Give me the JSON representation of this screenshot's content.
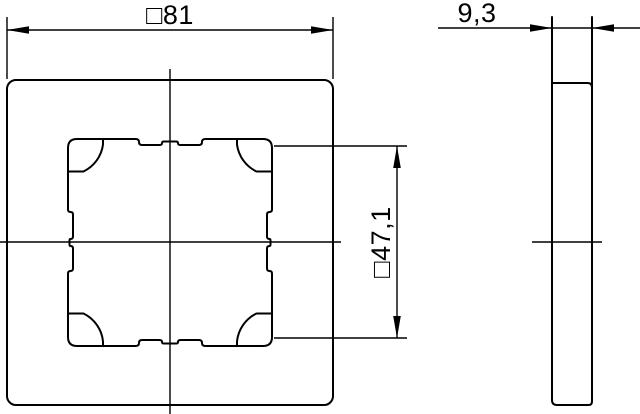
{
  "colors": {
    "line": "#000000",
    "background": "#ffffff"
  },
  "drawing": {
    "dimensions": {
      "outer_width_label": "□81",
      "inner_opening_label": "□47,1",
      "thickness_label": "9,3"
    }
  }
}
